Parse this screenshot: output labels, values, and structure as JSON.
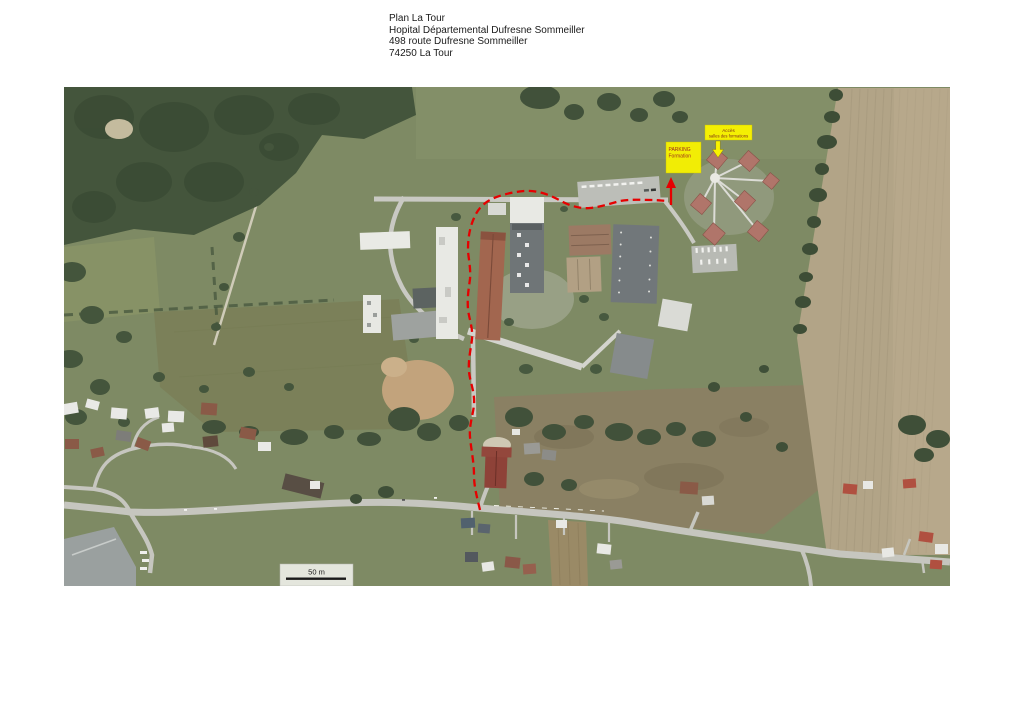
{
  "header": {
    "line1": "Plan La Tour",
    "line2": "Hopital Départemental Dufresne Sommeiller",
    "line3": "498 route Dufresne Sommeiller",
    "line4": "74250 La Tour"
  },
  "map": {
    "type": "aerial-satellite-plan",
    "description": "Aerial photo plan of the hospital campus at La Tour with a dashed red route from the main road through the campus up to the training parking",
    "labels": {
      "parking": {
        "line1": "PARKING",
        "line2": "Formation"
      },
      "access": {
        "line1": "Accès",
        "line2": "salles des formations"
      }
    },
    "scale_bar": {
      "label": "50 m"
    },
    "route": {
      "style": "dashed",
      "color": "#e60000"
    },
    "colors": {
      "route_red": "#e60000",
      "highlight_yellow": "#f8f200",
      "label_text_red": "#9c2a1e",
      "forest_green": "#44553c",
      "field_green": "#7e8a64",
      "field_olive": "#7b8059",
      "field_tan": "#b2a487",
      "road_gray": "#c6c6bf"
    }
  }
}
